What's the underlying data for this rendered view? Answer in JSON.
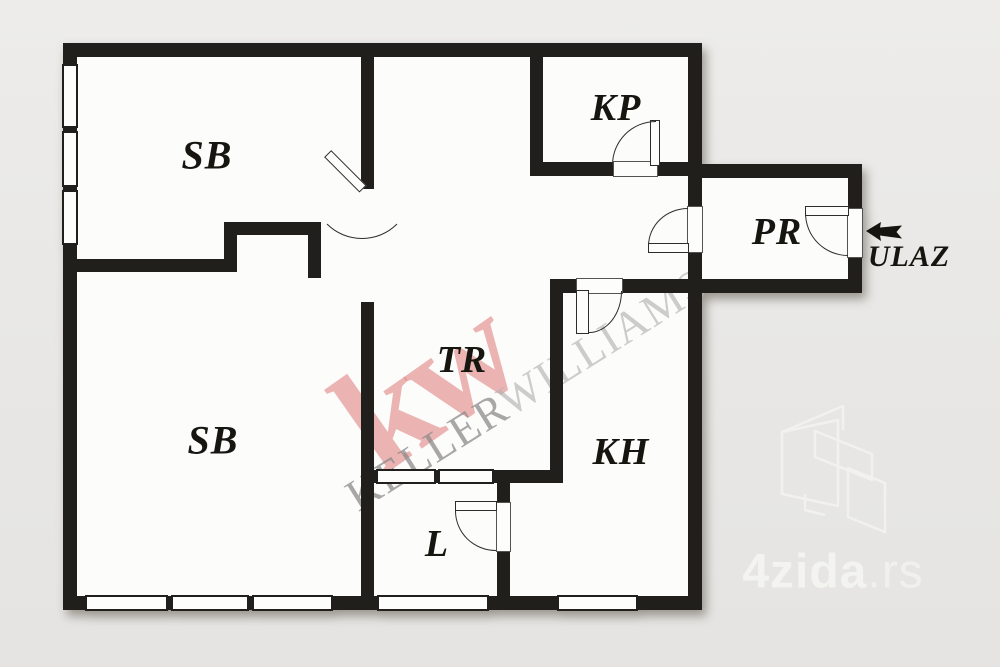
{
  "plan": {
    "rooms": [
      {
        "id": "sb-top",
        "label": "SB"
      },
      {
        "id": "kp",
        "label": "KP"
      },
      {
        "id": "pr",
        "label": "PR"
      },
      {
        "id": "tr",
        "label": "TR"
      },
      {
        "id": "sb-bottom",
        "label": "SB"
      },
      {
        "id": "kh",
        "label": "KH"
      },
      {
        "id": "l",
        "label": "L"
      }
    ],
    "entrance": {
      "label": "ULAZ",
      "arrow_icon": "arrow-left-icon"
    }
  },
  "watermarks": {
    "kw_logo": {
      "text": "kw",
      "color": "#e28b89"
    },
    "agency": {
      "part1": "KELLER",
      "part2": "WILLIAMS.",
      "color1": "#a6a6a6",
      "color2": "#c9c9c9"
    },
    "portal": {
      "name": "4zida",
      "tld": ".rs",
      "color": "#f3f3f0",
      "logo": "unfolded-walls-icon"
    }
  },
  "colors": {
    "wall": "#201f1b",
    "floor": "#fcfcfb",
    "background": "#e9e8e6"
  }
}
